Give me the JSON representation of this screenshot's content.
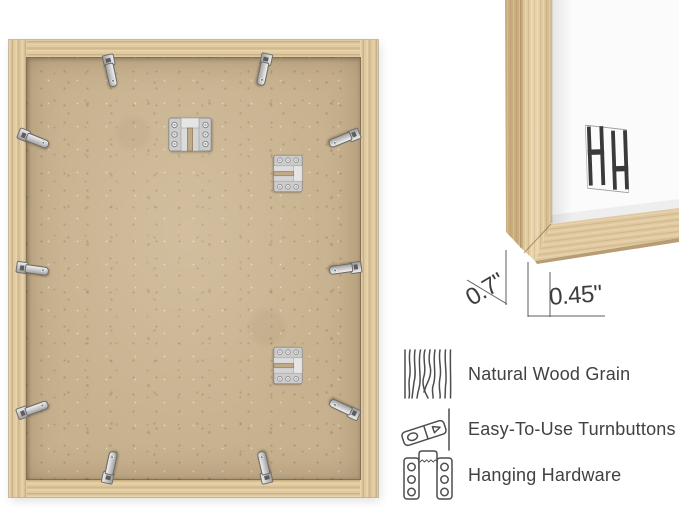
{
  "corner_detail": {
    "depth_dimension": "0.7\"",
    "face_dimension": "0.45\"",
    "brand_logo_text": "HH"
  },
  "features": [
    {
      "icon": "wood-grain-icon",
      "label": "Natural Wood Grain"
    },
    {
      "icon": "turnbutton-icon",
      "label": "Easy-To-Use Turnbuttons"
    },
    {
      "icon": "hanging-hardware-icon",
      "label": "Hanging Hardware"
    }
  ],
  "colors": {
    "wood_light": "#e8d4ac",
    "wood_mid": "#d9c197",
    "wood_dark": "#cbb083",
    "mdf_backing": "#c7b18e",
    "metal_hardware": "#cccccc",
    "annotation_text": "#3c3c3c",
    "background": "#ffffff"
  }
}
